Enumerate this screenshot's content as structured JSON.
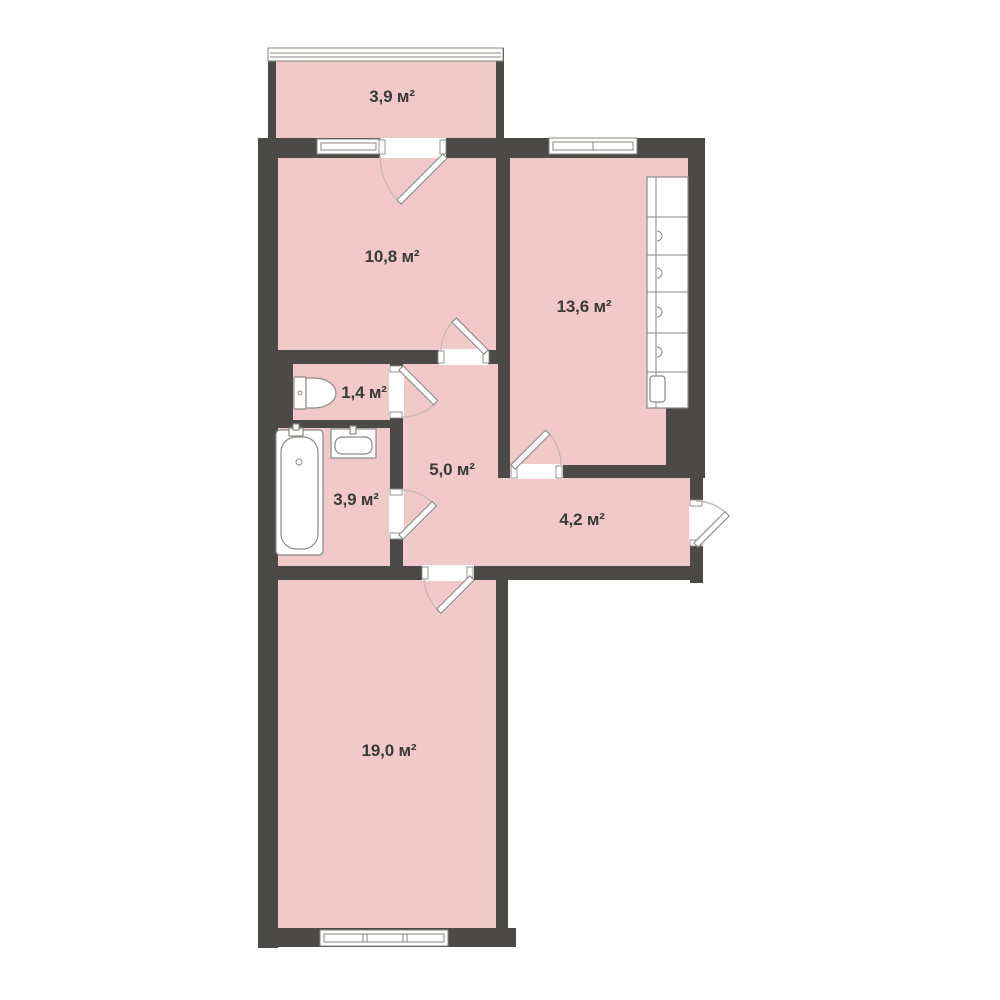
{
  "colors": {
    "wall": "#4b4a47",
    "floor": "#f2c9c9",
    "background": "#ffffff",
    "window_stroke": "#85847f",
    "fixture_stroke": "#8a8a88",
    "arc": "#c9b8b4",
    "text": "#3a3a38"
  },
  "unit_suffix": "м²",
  "rooms": [
    {
      "id": "balcony",
      "label": "3,9 м²"
    },
    {
      "id": "bedroom",
      "label": "10,8 м²"
    },
    {
      "id": "kitchen",
      "label": "13,6 м²"
    },
    {
      "id": "wc",
      "label": "1,4 м²"
    },
    {
      "id": "hallway",
      "label": "5,0 м²"
    },
    {
      "id": "bathroom",
      "label": "3,9 м²"
    },
    {
      "id": "corridor",
      "label": "4,2 м²"
    },
    {
      "id": "living-room",
      "label": "19,0 м²"
    }
  ]
}
